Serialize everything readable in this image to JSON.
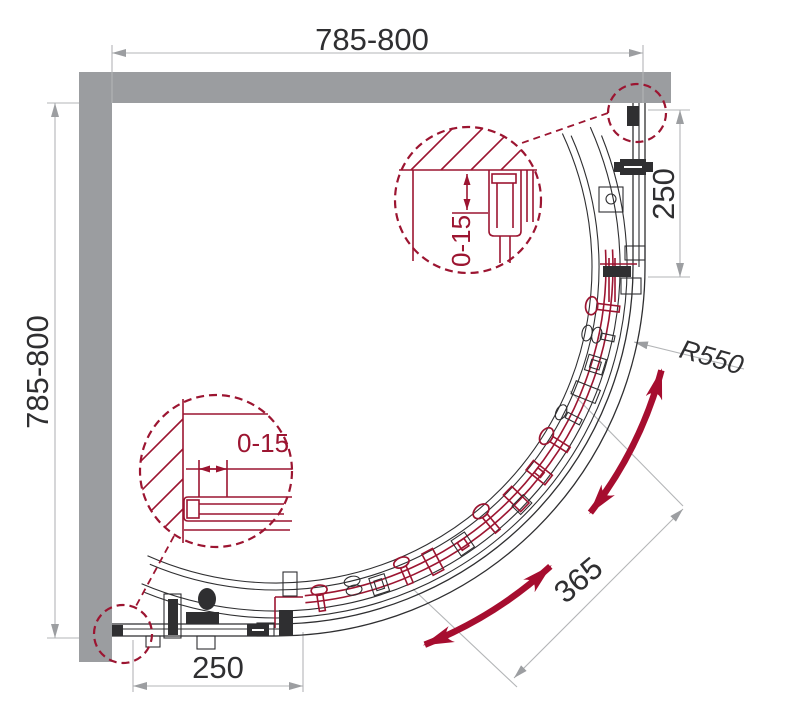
{
  "drawing": {
    "title": "quadrant-shower-enclosure-plan",
    "dimensions": {
      "top_width": "785-800",
      "left_height": "785-800",
      "right_inset": "250",
      "bottom_inset": "250",
      "radius": "R550",
      "door_travel": "365",
      "adjust_top": "0-15",
      "adjust_bottom": "0-15"
    },
    "colors": {
      "wall": "#9b9da0",
      "dim_line": "#b3b5b7",
      "dim_arrow": "#9c9ea1",
      "dim_text": "#2f2f31",
      "drawing_line": "#2f2f31",
      "accent_red": "#9c1531",
      "arrow_red": "#a60d2f",
      "background": "#ffffff"
    }
  }
}
